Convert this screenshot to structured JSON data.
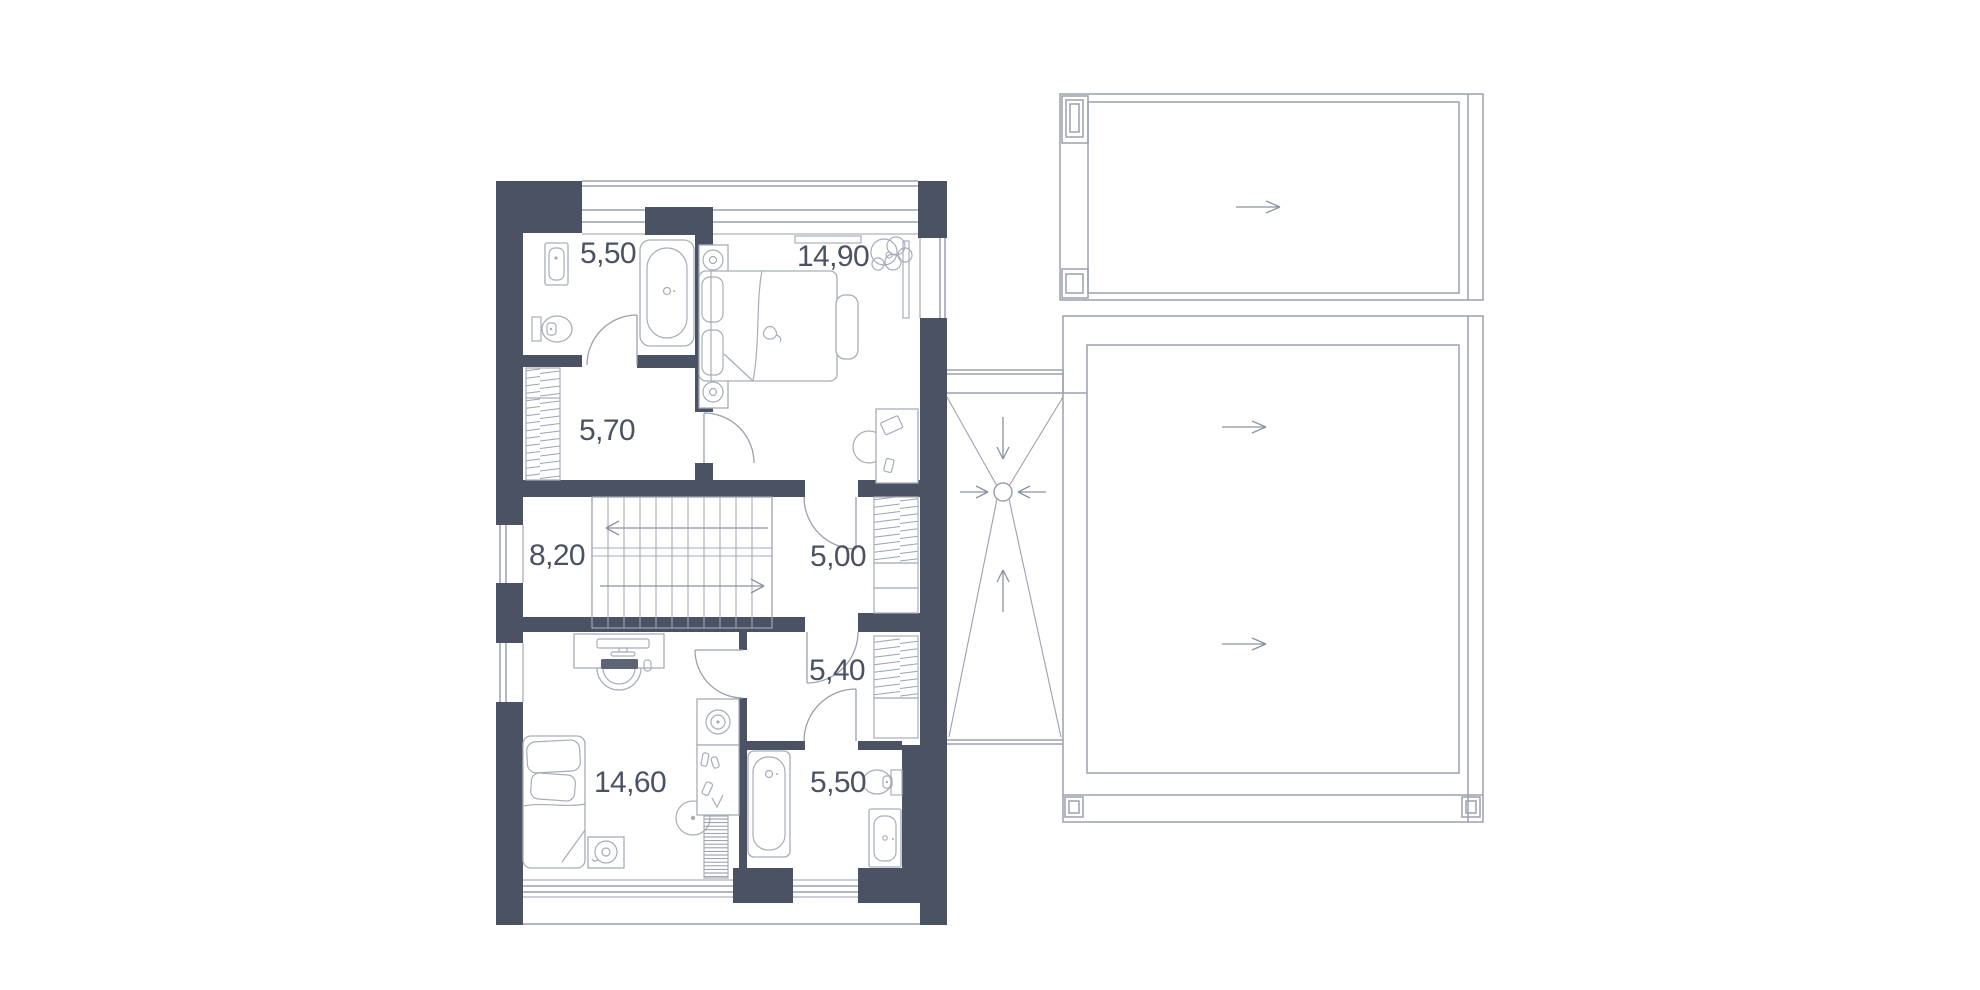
{
  "rooms": [
    {
      "id": "bathroom-top",
      "area": "5,50"
    },
    {
      "id": "bedroom-top",
      "area": "14,90"
    },
    {
      "id": "hall",
      "area": "5,70"
    },
    {
      "id": "stair-hall",
      "area": "8,20"
    },
    {
      "id": "corridor",
      "area": "5,00"
    },
    {
      "id": "walk-in-closet",
      "area": "5,40"
    },
    {
      "id": "bedroom-bottom",
      "area": "14,60"
    },
    {
      "id": "bathroom-bottom",
      "area": "5,50"
    }
  ],
  "colors": {
    "wall": "#4a5263",
    "line": "#9aa1ae",
    "furniture": "#a6adb9",
    "text": "#4a5263",
    "background": "#ffffff"
  }
}
